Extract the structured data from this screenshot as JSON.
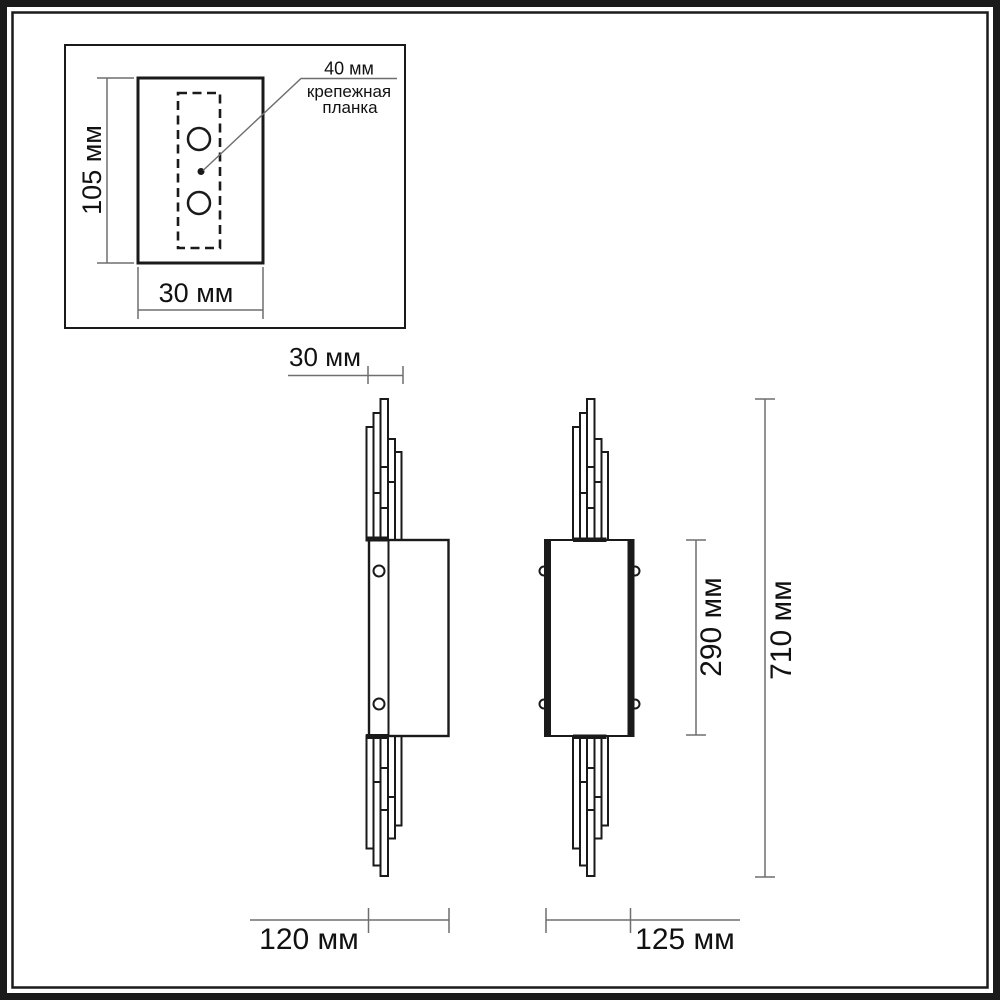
{
  "colors": {
    "line": "#1a1a1a",
    "dim": "#6e6e6e",
    "text": "#111111",
    "background": "#ffffff"
  },
  "detail_box": {
    "callout": {
      "value": "40 мм",
      "label_line1": "крепежная",
      "label_line2": "планка"
    },
    "dims": {
      "height": "105 мм",
      "width": "30 мм"
    }
  },
  "side_view": {
    "dims": {
      "depth": "30 мм",
      "width": "120 мм"
    }
  },
  "front_view": {
    "dims": {
      "width": "125 мм",
      "body_height": "290 мм",
      "total_height": "710 мм"
    }
  }
}
